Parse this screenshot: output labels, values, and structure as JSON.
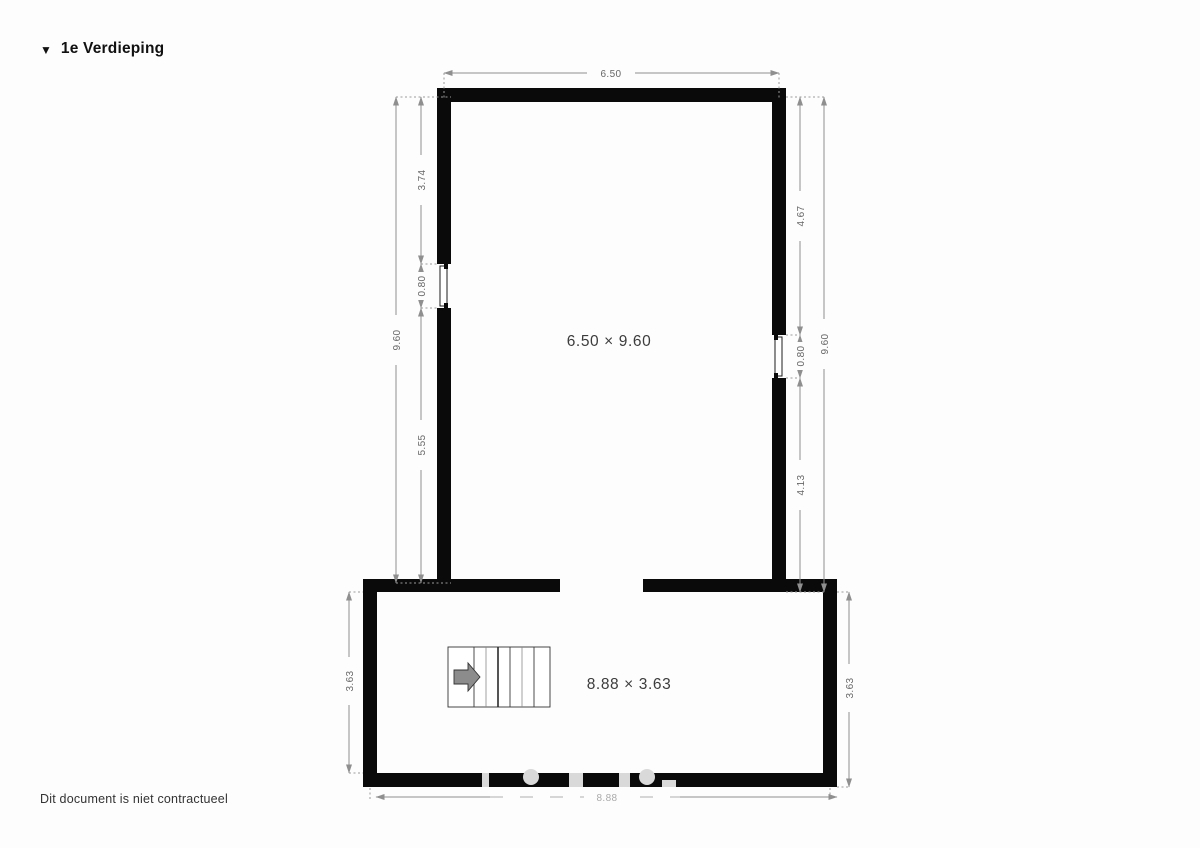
{
  "page": {
    "background": "#fdfdfd"
  },
  "header": {
    "collapse_icon": "▼",
    "title": "1e Verdieping"
  },
  "footer": {
    "disclaimer": "Dit document is niet contractueel"
  },
  "floorplan": {
    "wall_color": "#0a0a0a",
    "dimension_line_color": "#909090",
    "rooms": [
      {
        "id": "main-room",
        "size_label": "6.50 × 9.60"
      },
      {
        "id": "stair-hall",
        "size_label": "8.88 × 3.63"
      }
    ],
    "dimensions": {
      "top_width": "6.50",
      "left_outer_height": "9.60",
      "left_segments": [
        "3.74",
        "0.80",
        "5.55"
      ],
      "right_outer_height": "9.60",
      "right_segments": [
        "4.67",
        "0.80",
        "4.13"
      ],
      "hall_left_height": "3.63",
      "hall_right_height": "3.63",
      "hall_bottom_width": "8.88"
    },
    "stairs": {
      "icon": "stairs-up-arrow-right"
    }
  }
}
